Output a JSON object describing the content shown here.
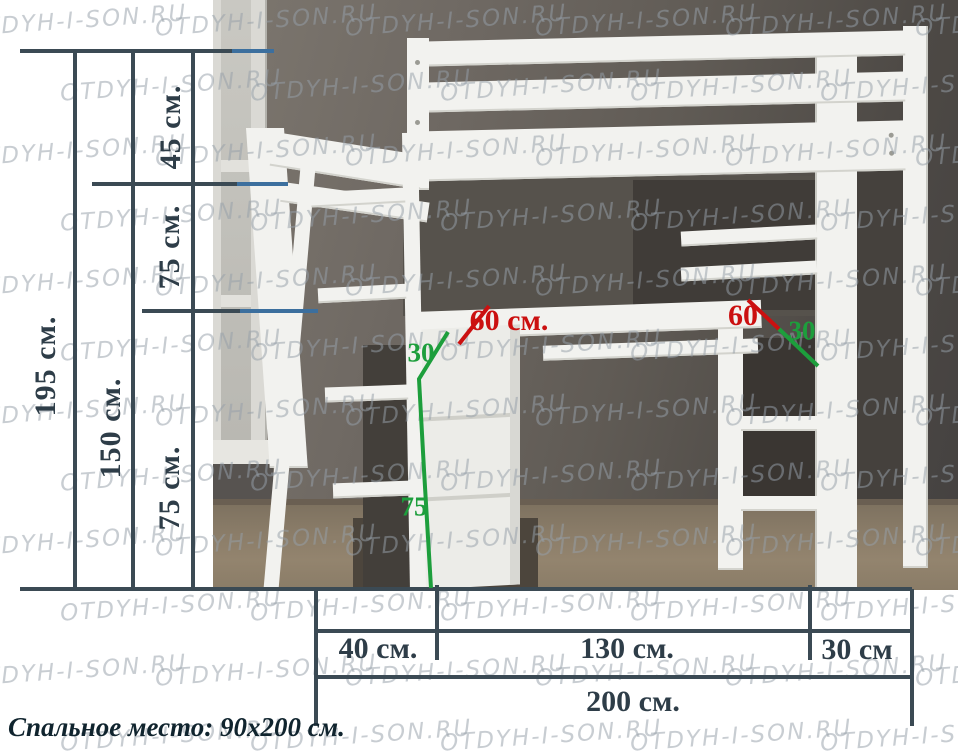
{
  "watermark": {
    "text": "OTDYH-I-SON.RU"
  },
  "labels": {
    "height_total": "195 см.",
    "height_floor_to_bed": "150 см.",
    "rail_height": "45 см.",
    "upper_section": "75 см.",
    "lower_section": "75 см.",
    "desk_depth_left": "60 см.",
    "desk_depth_right": "60",
    "shelf_depth_left": "30",
    "cabinet_height": "75",
    "shelf_depth_right": "30",
    "width_ladder": "40 см.",
    "width_bed": "130 см.",
    "width_shelf": "30 см",
    "width_total": "200 см."
  },
  "caption": "Спальное место: 90х200 см.",
  "colors": {
    "dim_line": "#3b4a54",
    "pointer_blue": "#3c6f9e",
    "red": "#cb1010",
    "green": "#1d9e3c",
    "label_text": "#2e3d48",
    "caption_text": "#10242e",
    "watermark": "rgba(150,159,168,0.52)"
  }
}
